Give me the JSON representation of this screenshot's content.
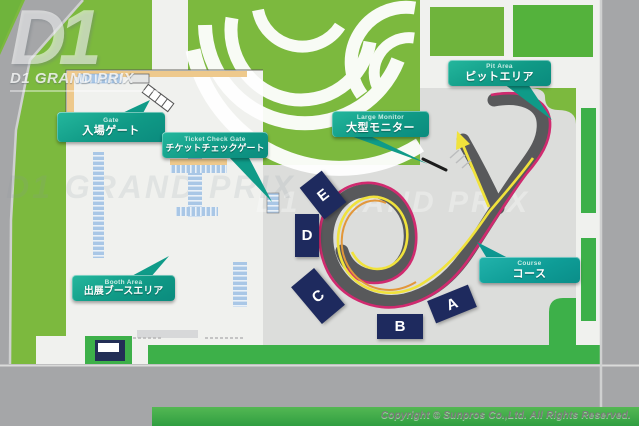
{
  "meta": {
    "title": "D1 Grand Prix event venue map"
  },
  "logo": {
    "mark": "D1",
    "title": "D1 GRAND PRIX"
  },
  "badges": [
    {
      "id": "gate",
      "en": "Gate",
      "jp": "入場ゲート"
    },
    {
      "id": "ticket-check-gate",
      "en": "Ticket Check Gate",
      "jp": "チケットチェックゲート"
    },
    {
      "id": "large-monitor",
      "en": "Large Monitor",
      "jp": "大型モニター"
    },
    {
      "id": "pit-area",
      "en": "Pit Area",
      "jp": "ピットエリア"
    },
    {
      "id": "booth-area",
      "en": "Booth Area",
      "jp": "出展ブースエリア"
    },
    {
      "id": "course",
      "en": "Course",
      "jp": "コース"
    }
  ],
  "stands": [
    {
      "label": "E"
    },
    {
      "label": "D"
    },
    {
      "label": "C"
    },
    {
      "label": "B"
    },
    {
      "label": "A"
    }
  ],
  "watermarks": {
    "paved": "D1 GRAND PRIX",
    "plaza": "D1 GRAND PRIX"
  },
  "footer": {
    "copyright": "Copyright © Sunpros Co.,Ltd. All Rights Reserved."
  },
  "colors": {
    "field_green": "#7cb93e",
    "strip_green": "#3db049",
    "road_gray": "#a5a6a8",
    "paved_gray": "#dcdddb",
    "badge_teal": "#12a28d",
    "stand_navy": "#1e2a5e",
    "track_gray": "#58595b",
    "line_pink": "#d02a6f",
    "line_yellow": "#f0e23c",
    "line_orange": "#e2973b",
    "booth_blue": "#a9c7e6",
    "gate_beige": "#eec98c"
  }
}
